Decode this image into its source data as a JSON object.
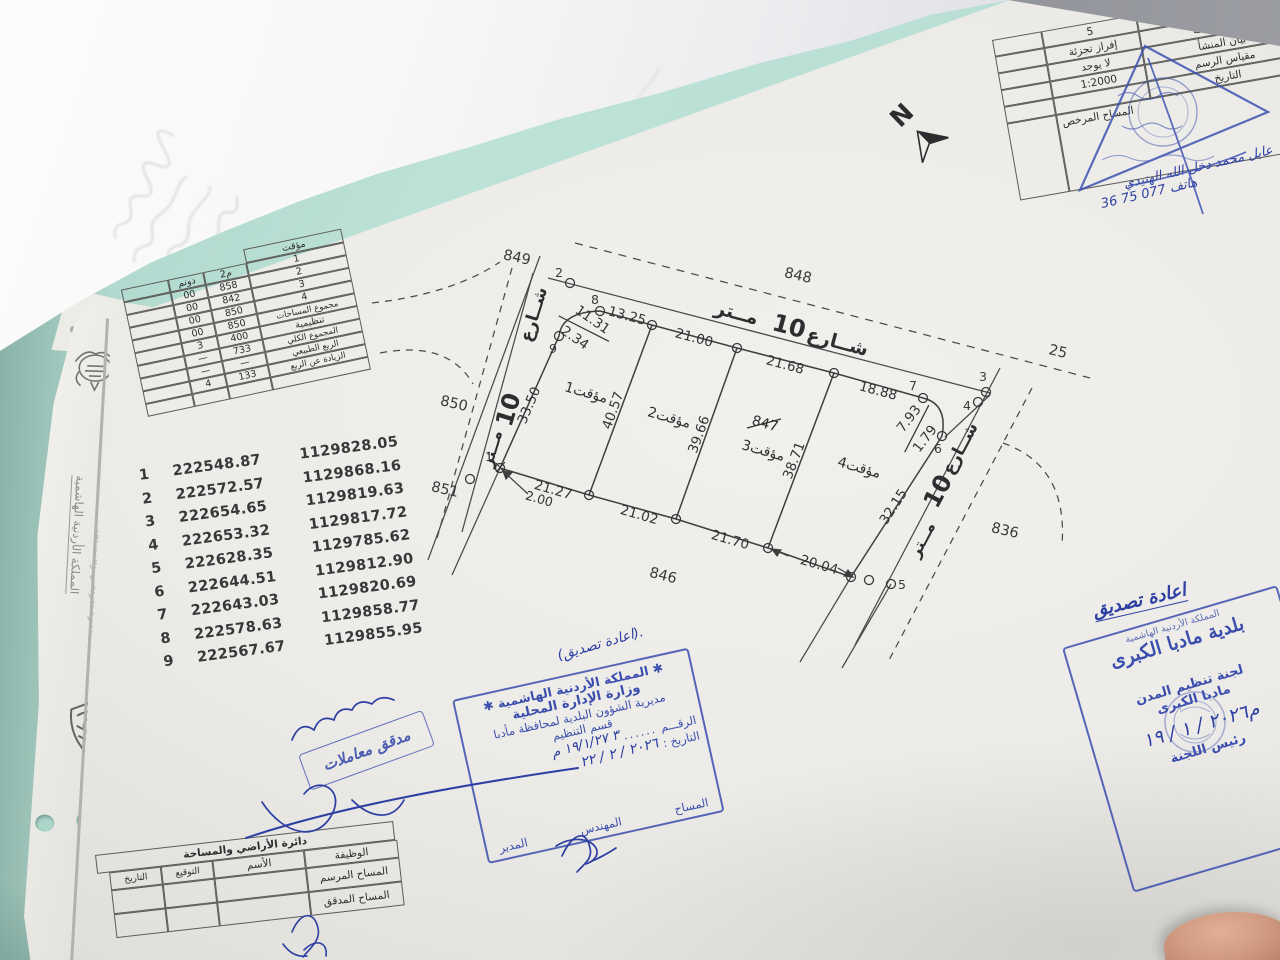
{
  "plan": {
    "north_label": "N",
    "street_word": "شــارع",
    "street_num": "10",
    "street_unit": "مــتر",
    "neighbors": {
      "nw": "849",
      "n": "848",
      "ne": "25",
      "se": "836",
      "s": "846",
      "w": "850",
      "sw": "851"
    },
    "parcels": {
      "p1": "1مؤقت",
      "p2": "2مؤقت",
      "p3": "3مؤقت",
      "p3_old": "847",
      "p4": "4مؤقت"
    },
    "points": {
      "p1": "1",
      "p2": "2",
      "p3": "3",
      "p4": "4",
      "p5": "5",
      "p6": "6",
      "p7": "7",
      "p8": "8",
      "p9": "9"
    },
    "dims": {
      "top_curve_a": "11.31",
      "top_curve_b": "2.34",
      "top_1": "13.25",
      "top_2": "21.00",
      "top_3": "21.68",
      "top_4": "18.88",
      "right_curve_a": "7.93",
      "right_curve_b": "1.79",
      "west": "33.50",
      "div_a": "40.57",
      "div_b": "39.66",
      "div_c": "38.71",
      "east": "32.15",
      "bottom_1": "21.27",
      "bottom_offset": "2.00",
      "bottom_2": "21.02",
      "bottom_3": "21.70",
      "bottom_4": "20.04"
    }
  },
  "coordinates": {
    "rows": [
      {
        "id": "1",
        "x": "222548.87",
        "y": "1129828.05"
      },
      {
        "id": "2",
        "x": "222572.57",
        "y": "1129868.16"
      },
      {
        "id": "3",
        "x": "222654.65",
        "y": "1129819.63"
      },
      {
        "id": "4",
        "x": "222653.32",
        "y": "1129817.72"
      },
      {
        "id": "5",
        "x": "222628.35",
        "y": "1129785.62"
      },
      {
        "id": "6",
        "x": "222644.51",
        "y": "1129812.90"
      },
      {
        "id": "7",
        "x": "222643.03",
        "y": "1129820.69"
      },
      {
        "id": "8",
        "x": "222578.63",
        "y": "1129858.77"
      },
      {
        "id": "9",
        "x": "222567.67",
        "y": "1129855.95"
      }
    ]
  },
  "area_table": {
    "header": "مؤقت",
    "col_dunum": "دونم",
    "col_m2": "م2",
    "rows": [
      {
        "label": "1",
        "dunum": "00",
        "m2": "858"
      },
      {
        "label": "2",
        "dunum": "00",
        "m2": "842"
      },
      {
        "label": "3",
        "dunum": "00",
        "m2": "850"
      },
      {
        "label": "4",
        "dunum": "00",
        "m2": "850"
      },
      {
        "label": "مجموع المساحات",
        "dunum": "3",
        "m2": "400"
      },
      {
        "label": "تنظيمية",
        "dunum": "—",
        "m2": "733"
      },
      {
        "label": "المجموع الكلي",
        "dunum": "—",
        "m2": "—"
      },
      {
        "label": "الربع الطبيعي",
        "dunum": "4",
        "m2": "133"
      },
      {
        "label": "الزيادة عن الربع",
        "dunum": "",
        "m2": ""
      }
    ]
  },
  "info_table": {
    "rows": [
      {
        "label": "رقم اللوحة",
        "value": "5"
      },
      {
        "label": "نوع المعاملة",
        "value": "إفراز تجزئة"
      },
      {
        "label": "بيان المنشأ",
        "value": "لا يوجد"
      },
      {
        "label": "مقياس الرسم",
        "value": "1:2000"
      },
      {
        "label": "التاريخ",
        "value": ""
      }
    ],
    "surveyor_label": "المساح المرخص",
    "surveyor_name": "عايل محمد دخل الله الهنيدي",
    "surveyor_phone": "هاتف 077 75 36"
  },
  "stamps": {
    "ministry": {
      "note": "(اعادة تصديق).",
      "star": "✱",
      "line1": "المملكة الأردنية الهاشمية",
      "line2": "وزارة الإدارة المحلية",
      "line3": "مديرية الشؤون البلدية لمحافظة مأدبا",
      "line4": "قسم التنظيم",
      "number_label": "الرقـــم",
      "number_value": "٣ ١٩/١/٢٧ م",
      "date_label": "التاريخ :",
      "date_value": "٢٠٢٦ / ٢ / ٢٢",
      "sig1": "المساح",
      "sig2": "المهندس",
      "sig3": "المدير"
    },
    "committee": {
      "note": "اعادة تصديق",
      "line1": "المملكة الأردنية الهاشمية",
      "line2": "بلدية مادبا الكبرى",
      "line3": "لجنة تنظيم المدن",
      "line4": "مادبا الكبرى",
      "date": "م٢٠٢٦ / ١ / ١٩",
      "title": "رئيس اللجنة"
    },
    "auditor": {
      "label": "مدقق معاملات"
    }
  },
  "footer_table": {
    "title": "دائرة الأراضي والمساحة",
    "cols": [
      "الوظيفة",
      "الأسم",
      "التوقيع",
      "التاريخ"
    ],
    "rows": [
      {
        "role": "المساح المرسم"
      },
      {
        "role": "المساح المدقق"
      }
    ]
  },
  "side_papers": {
    "vertical_text": "المملكة الأردنية الهاشمية",
    "vertical_text2": "دائرة الأراضي والمساحة"
  }
}
